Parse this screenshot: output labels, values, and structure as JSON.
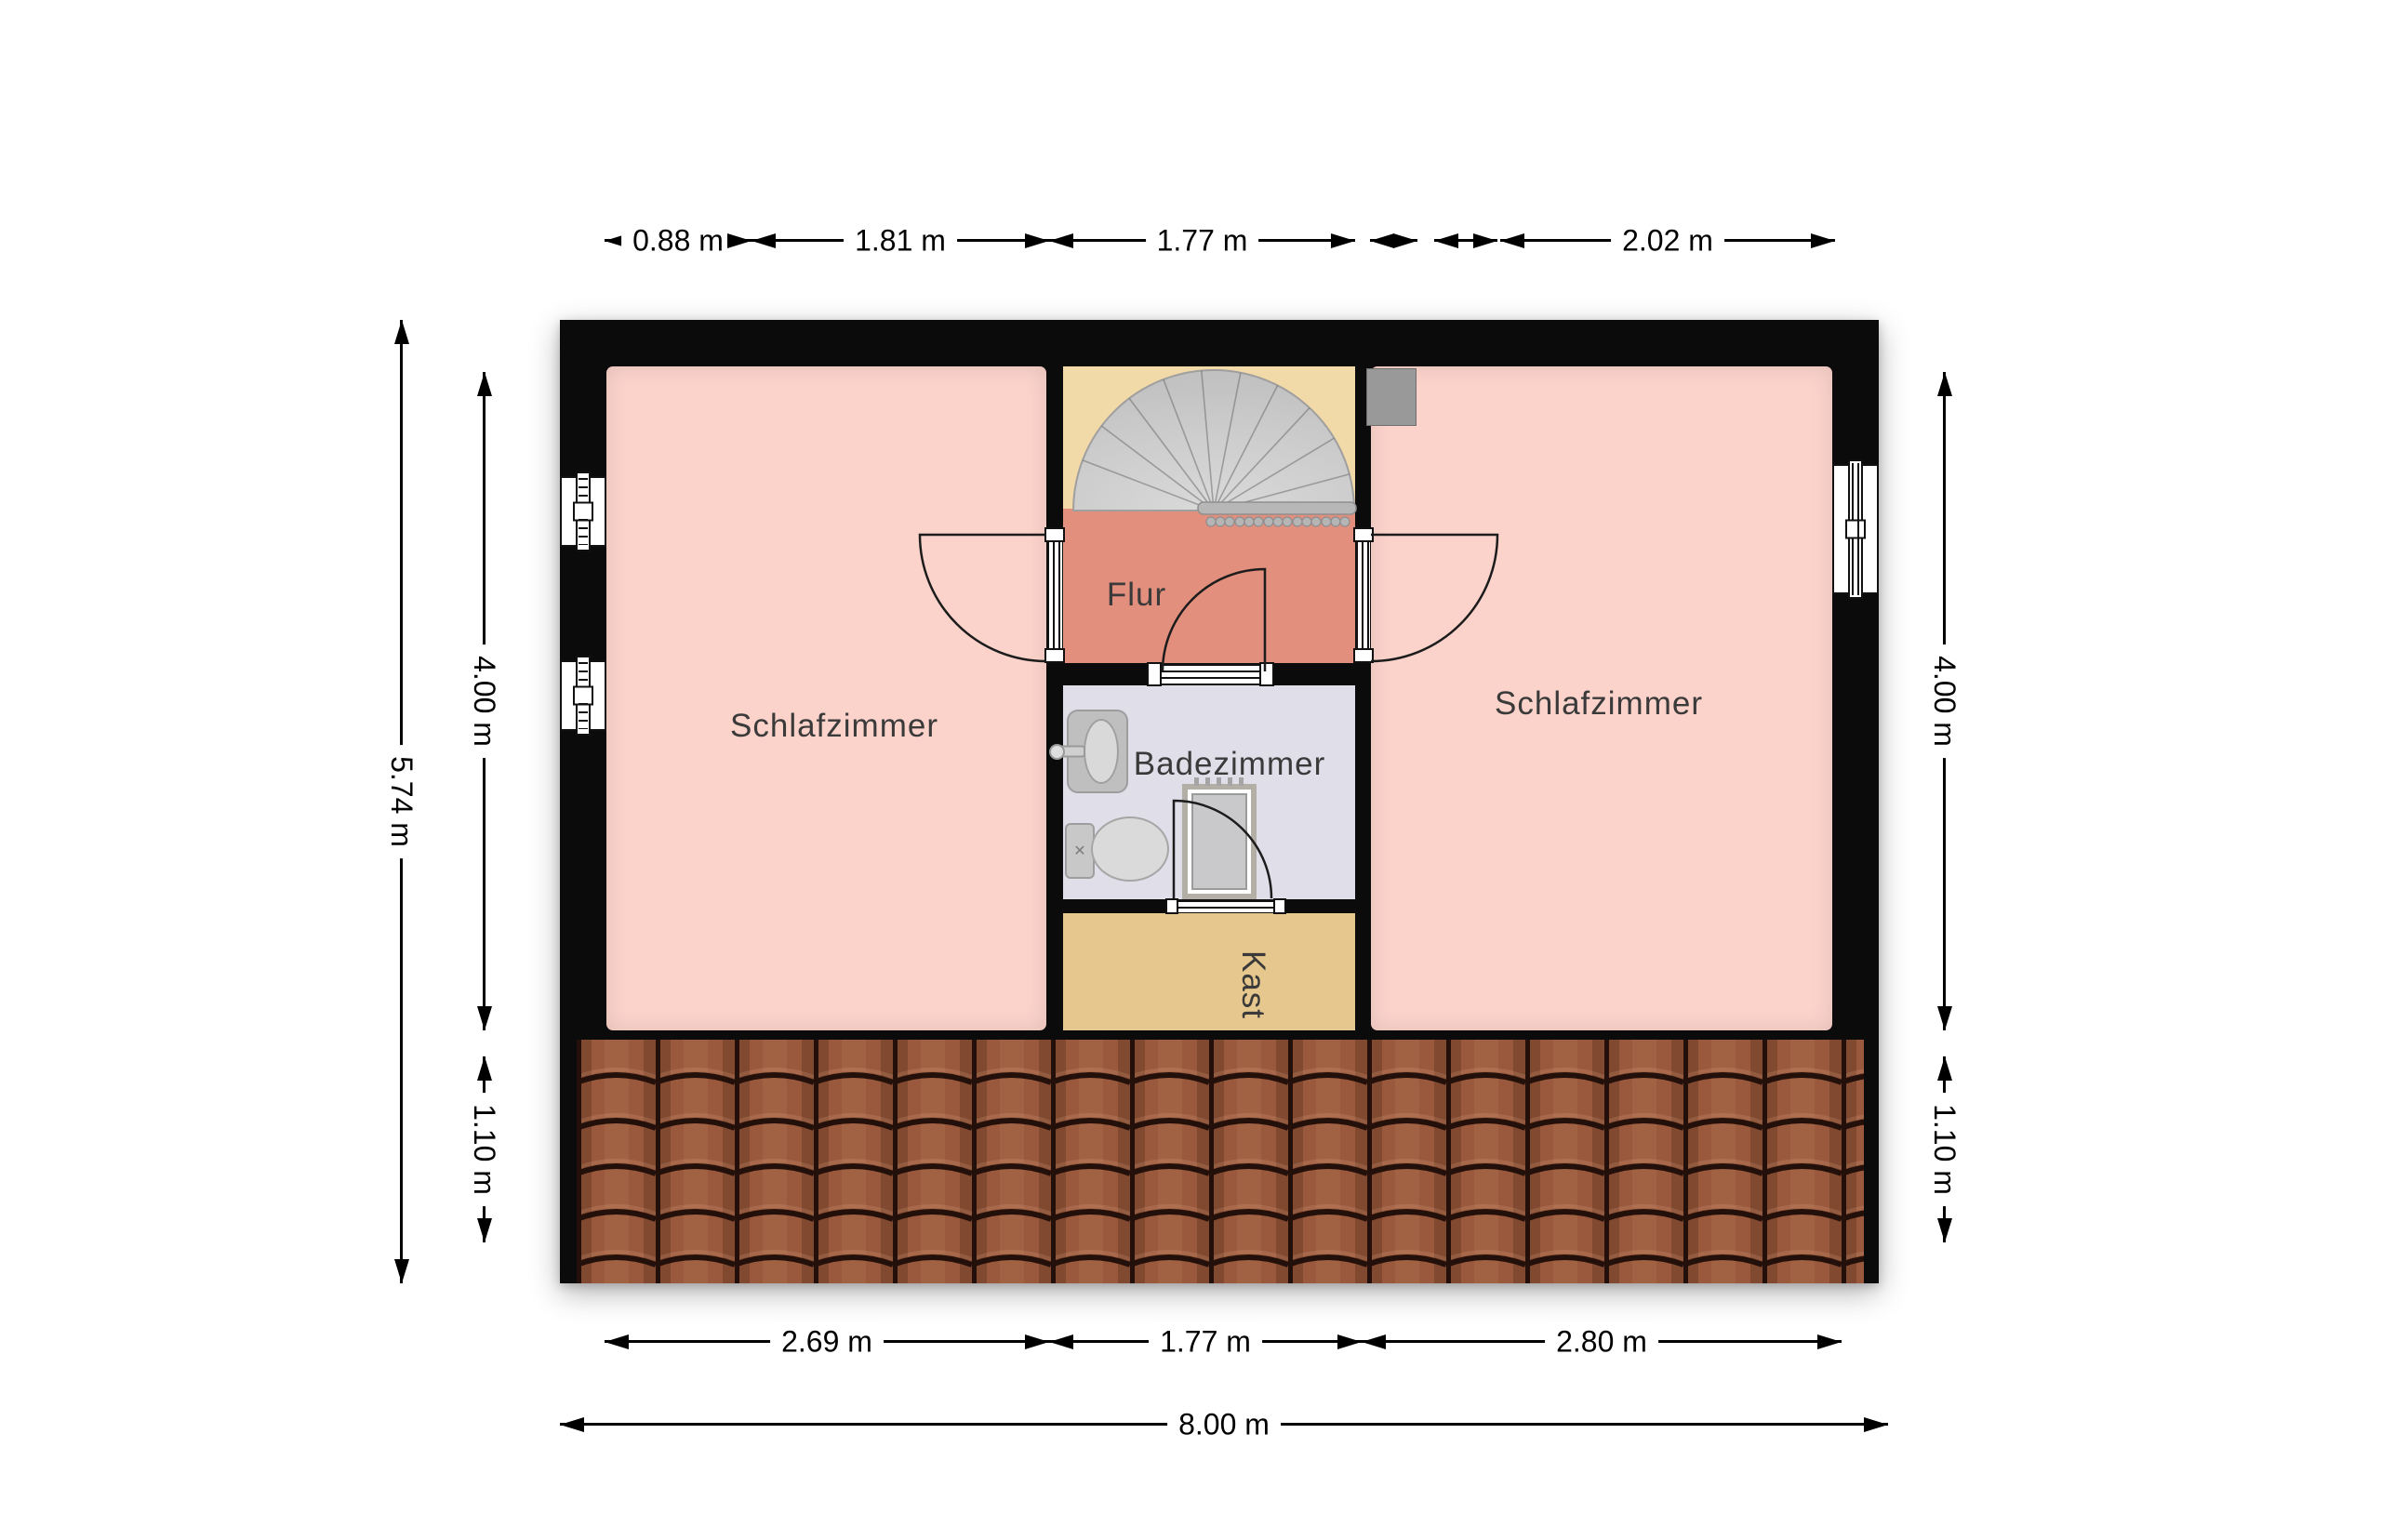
{
  "plan": {
    "type": "floor-plan",
    "rooms": [
      {
        "id": "bedroom-left",
        "label": "Schlafzimmer",
        "color": "#fbd3cb"
      },
      {
        "id": "hall",
        "label": "Flur",
        "color": "#e28f7d"
      },
      {
        "id": "bathroom",
        "label": "Badezimmer",
        "color": "#dfdee9"
      },
      {
        "id": "closet",
        "label": "Kast",
        "color": "#e6c78d"
      },
      {
        "id": "bedroom-right",
        "label": "Schlafzimmer",
        "color": "#fbd3cb"
      }
    ],
    "icons": [
      "spiral-stairs-icon",
      "handrail-icon",
      "chimney-icon",
      "window-icon",
      "door-swing-icon",
      "sink-icon",
      "toilet-icon",
      "shower-icon",
      "roof-tiles-icon"
    ],
    "colors": {
      "wall": "#0b0b0b",
      "stair_area": "#f2d9a8",
      "stairs": "#cacaca",
      "roof_tile": "#9a593c",
      "chimney": "#999999",
      "dimension_line": "#000000",
      "label_text": "#3a3a3a"
    }
  },
  "dimensions": {
    "top": [
      {
        "label": "0.88 m"
      },
      {
        "label": "1.81 m"
      },
      {
        "label": "1.77 m"
      },
      {
        "label": ""
      },
      {
        "label": ""
      },
      {
        "label": "2.02 m"
      }
    ],
    "left": {
      "outer": "5.74 m",
      "upper": "4.00 m",
      "lower": "1.10 m"
    },
    "right": {
      "upper": "4.00 m",
      "lower": "1.10 m"
    },
    "bottom": {
      "segments": [
        {
          "label": "2.69 m"
        },
        {
          "label": "1.77 m"
        },
        {
          "label": "2.80 m"
        }
      ],
      "total": "8.00 m"
    }
  }
}
